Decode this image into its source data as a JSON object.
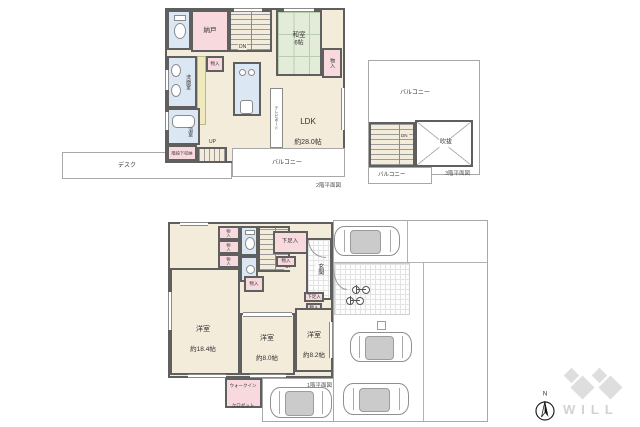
{
  "common": {
    "monoire": "物入",
    "balcony": "バルコニー",
    "getabako": "下足入",
    "up": "UP",
    "dn": "DN"
  },
  "floor2": {
    "caption": "2階平面図",
    "nando": "納戸",
    "washitsu": "和室",
    "washitsu_size": "6帖",
    "senmen": "洗面室",
    "bath": "浴室",
    "under_stair": "階段下収納",
    "ldk": "LDK",
    "ldk_size": "約28.0帖",
    "tv_board": "テレビボード",
    "desk": "デスク"
  },
  "floor3": {
    "caption": "3階平面図",
    "fukinuke": "吹抜"
  },
  "floor1": {
    "caption": "1階平面図",
    "genkan": "玄関",
    "room1": "洋室",
    "room1_size": "約18.4帖",
    "room2": "洋室",
    "room2_size": "約8.0帖",
    "room3": "洋室",
    "room3_size": "約8.2帖",
    "wic1": "ウォークイン",
    "wic2": "クロゼット"
  },
  "compass": {
    "north": "N"
  },
  "logo": {
    "text": "WILL"
  }
}
